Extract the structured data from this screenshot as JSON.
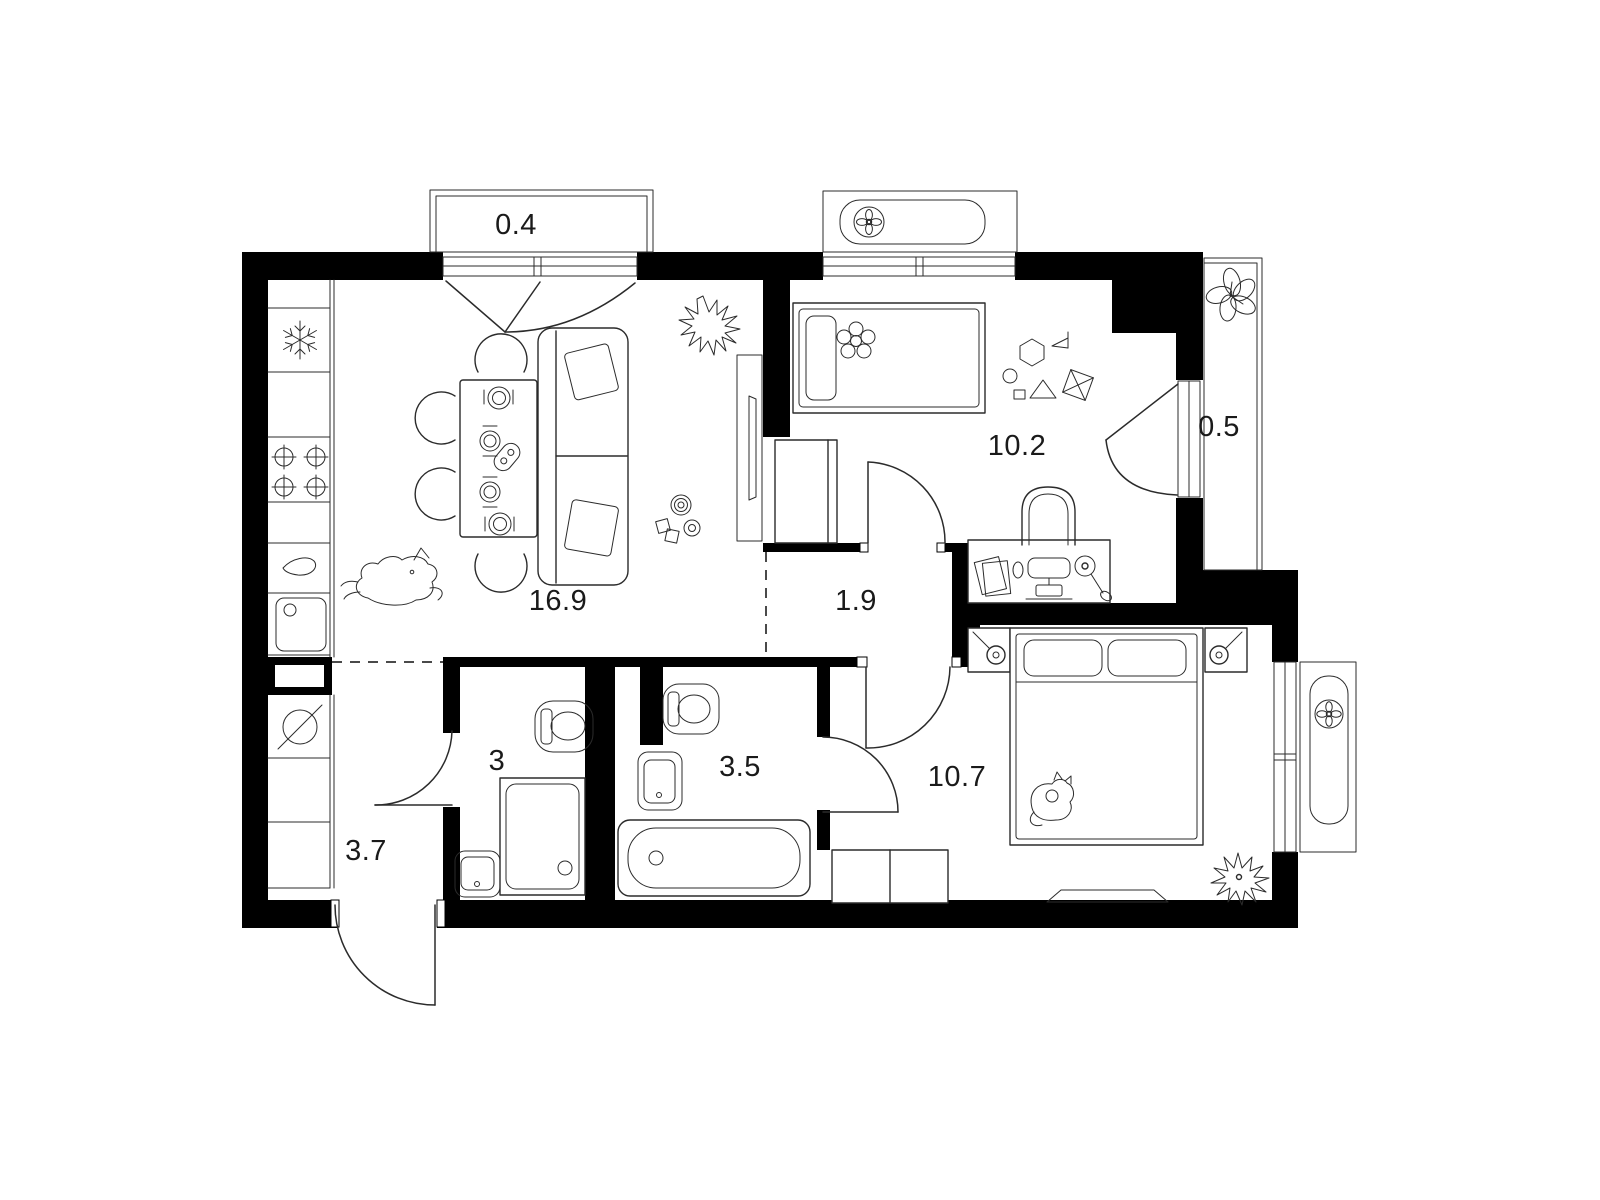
{
  "plan_title": "apartment-floor-plan",
  "colors": {
    "background": "#ffffff",
    "walls": "#000000",
    "furniture_lines": "#2b2b2b",
    "labels": "#1a1a1a"
  },
  "rooms": {
    "balcony_top": {
      "label": "0.4"
    },
    "child_bedroom": {
      "label": "10.2"
    },
    "balcony_right": {
      "label": "0.5"
    },
    "living_kitchen": {
      "label": "16.9"
    },
    "hallway": {
      "label": "1.9"
    },
    "bathroom_small": {
      "label": "3"
    },
    "bathroom_large": {
      "label": "3.5"
    },
    "entrance_hall": {
      "label": "3.7"
    },
    "master_bedroom": {
      "label": "10.7"
    }
  },
  "icons": {
    "fridge": "snowflake",
    "stove": "four-burner-crosshairs",
    "kitchen_sink": "square-basin",
    "cutting_board": "teardrop",
    "washing_machine": "circle-with-slash",
    "ac_units": "fan-in-pill",
    "plants": "star-and-leaf-clusters",
    "pets": "dog-and-cat-outlines",
    "sanitary": "toilet-shower-bathtub-sink",
    "doors": "quarter-circle-swings",
    "windows": "double-line-glazing"
  }
}
